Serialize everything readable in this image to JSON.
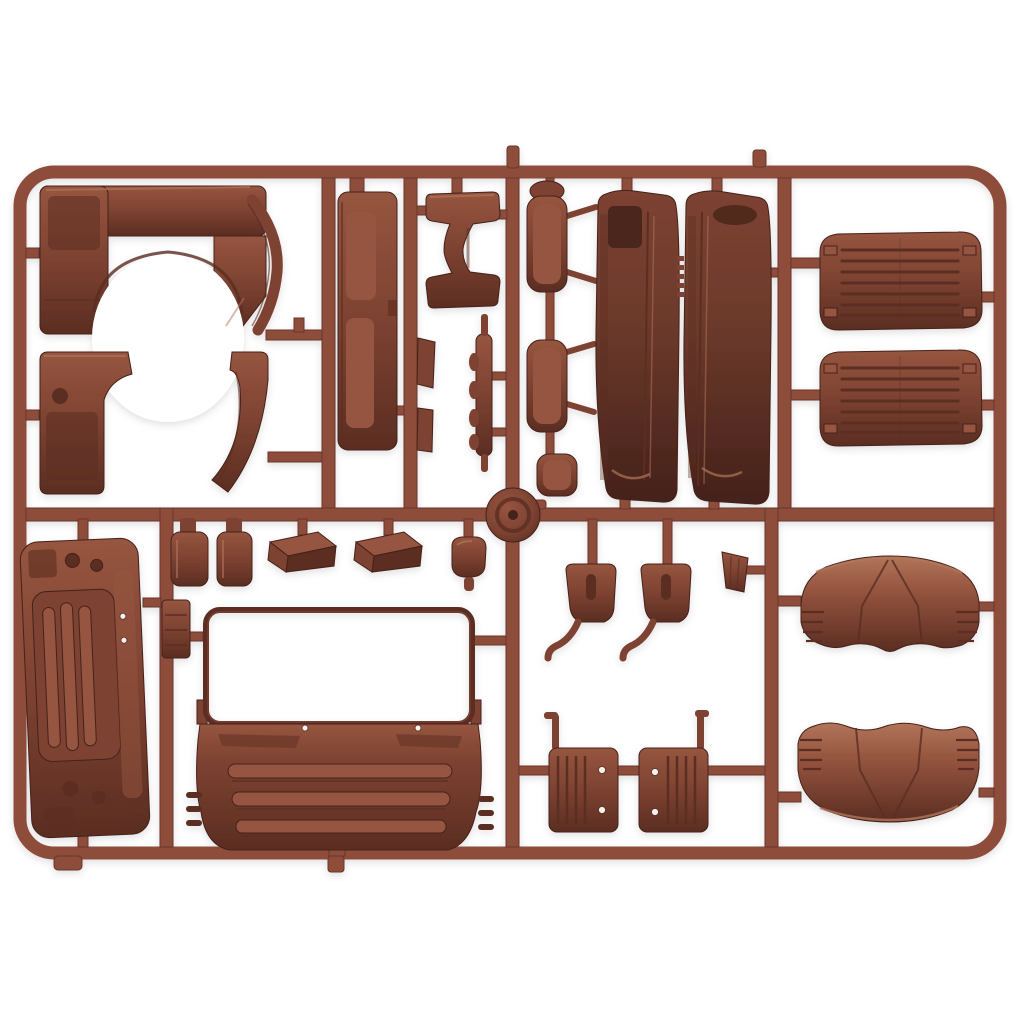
{
  "meta": {
    "alt": "Product photo of an injection-molded brown plastic model-kit sprue (parts tree) holding truck cab body parts: wheel-arch fender panels, rocker sill, seat frame, side mirrors, two cab door panels, two ribbed engine hatch covers, an engine access cover, seat-back panels, entry steps, a cab front panel with open windshield frame and louvered grille, step brackets, mud flaps with rivets, and two curved roof deflector panels, all joined by a rounded rectangular runner frame on a plain white background."
  },
  "palette": {
    "background": "#ffffff",
    "runner": "#8e4e3a",
    "runner-dark": "#67352a",
    "runner-light": "#a5654c",
    "part-base": "#7d4231",
    "part-light": "#96553f",
    "part-lighter": "#b1755a",
    "part-dark": "#5b2d22",
    "part-darker": "#44211a",
    "panel-dark": "#6b392b",
    "rivet": "#f6f1ec"
  },
  "sprue": {
    "frame_shape": "rounded rectangle runner with internal cross runners",
    "plastic_color_name": "red-brown",
    "parts": [
      {
        "name": "wheel-arch-panel-upper",
        "qty": 1,
        "zone": "top-left"
      },
      {
        "name": "wheel-arch-trim-strip",
        "qty": 2,
        "zone": "top-left"
      },
      {
        "name": "wheel-arch-panel-lower",
        "qty": 1,
        "zone": "top-left"
      },
      {
        "name": "rocker-sill-panel",
        "qty": 1,
        "zone": "top-center-left"
      },
      {
        "name": "seat-base-frame",
        "qty": 1,
        "zone": "top-center"
      },
      {
        "name": "small-strip-part",
        "qty": 2,
        "zone": "top-center"
      },
      {
        "name": "leaf-spring-part",
        "qty": 1,
        "zone": "top-center"
      },
      {
        "name": "side-mirror-housing",
        "qty": 2,
        "zone": "top-center"
      },
      {
        "name": "wide-angle-mirror-housing",
        "qty": 1,
        "zone": "top-center"
      },
      {
        "name": "cab-door-panel",
        "qty": 2,
        "zone": "top-center-right"
      },
      {
        "name": "engine-hatch-ribbed-panel",
        "qty": 2,
        "zone": "top-right"
      },
      {
        "name": "engine-access-cover",
        "qty": 1,
        "zone": "bottom-left"
      },
      {
        "name": "pillar-bracket",
        "qty": 1,
        "zone": "bottom-left"
      },
      {
        "name": "seat-back-panel",
        "qty": 2,
        "zone": "middle-row"
      },
      {
        "name": "entry-step",
        "qty": 2,
        "zone": "middle-row"
      },
      {
        "name": "lamp-housing-cover",
        "qty": 1,
        "zone": "middle-row"
      },
      {
        "name": "sprue-junction-disc",
        "qty": 1,
        "zone": "center"
      },
      {
        "name": "cab-front-panel-with-windshield-frame",
        "qty": 1,
        "zone": "bottom-center"
      },
      {
        "name": "air-intake-funnel",
        "qty": 1,
        "zone": "bottom-center-right"
      },
      {
        "name": "step-bracket",
        "qty": 2,
        "zone": "bottom-center-right"
      },
      {
        "name": "mud-flap",
        "qty": 2,
        "zone": "bottom-center-right"
      },
      {
        "name": "roof-deflector-panel",
        "qty": 2,
        "zone": "bottom-right"
      }
    ]
  }
}
